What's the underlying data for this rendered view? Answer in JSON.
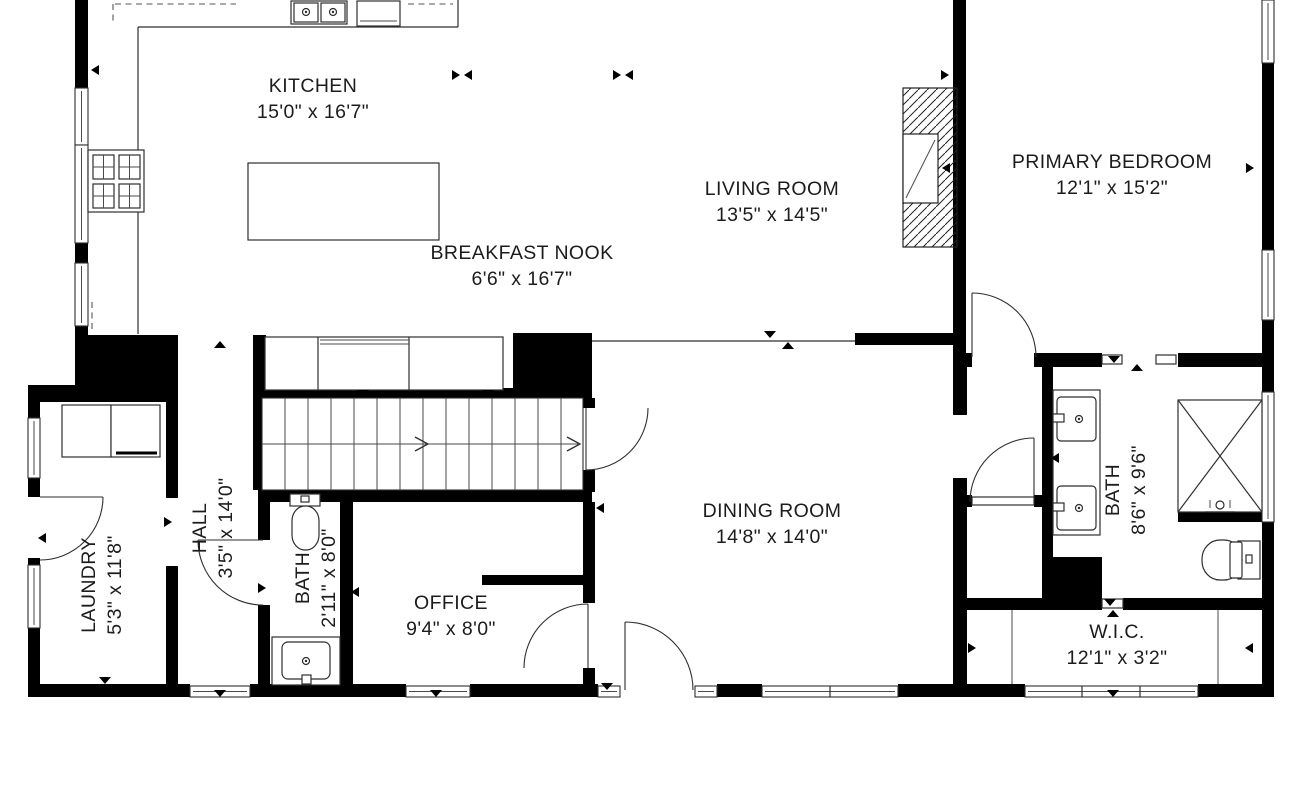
{
  "plan": {
    "rooms": [
      {
        "name": "KITCHEN",
        "dims": "15'0\" x 16'7\""
      },
      {
        "name": "BREAKFAST NOOK",
        "dims": "6'6\" x 16'7\""
      },
      {
        "name": "LIVING ROOM",
        "dims": "13'5\" x 14'5\""
      },
      {
        "name": "PRIMARY BEDROOM",
        "dims": "12'1\" x 15'2\""
      },
      {
        "name": "DINING ROOM",
        "dims": "14'8\" x 14'0\""
      },
      {
        "name": "OFFICE",
        "dims": "9'4\" x 8'0\""
      },
      {
        "name": "LAUNDRY",
        "dims": "5'3\" x 11'8\""
      },
      {
        "name": "HALL",
        "dims": "3'5\" x 14'0\""
      },
      {
        "name": "BATH",
        "dims": "2'11\" x 8'0\""
      },
      {
        "name": "BATH",
        "dims": "8'6\" x 9'6\""
      },
      {
        "name": "W.I.C.",
        "dims": "12'1\" x 3'2\""
      }
    ],
    "colors": {
      "wall": "#000000",
      "line": "#2e2e2e",
      "background": "#ffffff",
      "text": "#1c1c1c"
    }
  }
}
